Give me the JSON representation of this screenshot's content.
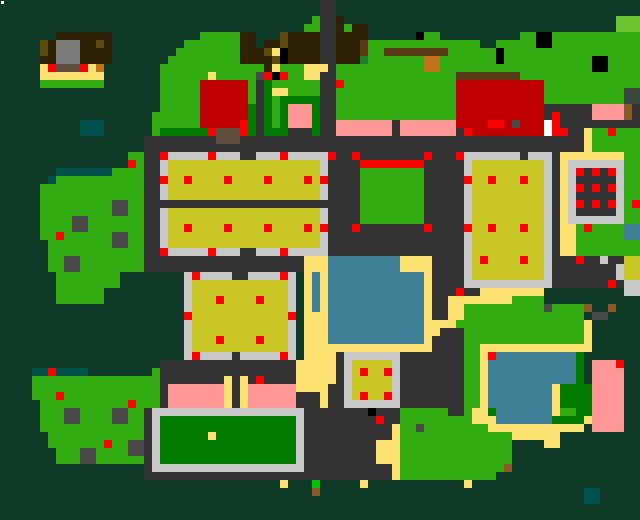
{
  "map": {
    "width_px": 640,
    "height_px": 520,
    "tile_size": 8,
    "cols": 80,
    "rows": 65,
    "palette": {
      ".": "#0d3926",
      "g": "#33ac12",
      "G": "#007b00",
      "l": "#6cc42e",
      "f": "#1e7d2b",
      "y": "#c9c626",
      "s": "#fce170",
      "r": "#323232",
      "L": "#c8c8c8",
      "m": "#4a4a4a",
      "M": "#7a7a7a",
      "R": "#ff0000",
      "D": "#c00000",
      "p": "#ff9797",
      "w": "#3e7f95",
      "b": "#2e2105",
      "B": "#5a3a17",
      "o": "#c1731f",
      "n": "#8b5a2b",
      "O": "#5e4b0e",
      "t": "#00514a",
      "W": "#ffffff",
      "K": "#000000",
      "h": "#5e4c3c",
      "e": "#37473c",
      "v": "#00c400"
    },
    "legend": {
      ".": "deep-forest",
      "g": "grass",
      "G": "dark-lawn",
      "l": "light-grass",
      "f": "shrub",
      "y": "crop-field",
      "s": "sand-path",
      "r": "road",
      "L": "pavement-border",
      "m": "rock",
      "M": "gray-roof",
      "R": "red-marker",
      "D": "red-building",
      "p": "pink-building",
      "w": "water",
      "b": "dark-brown-building",
      "B": "wood-beam",
      "o": "orange-crate",
      "n": "dirt-patch",
      "O": "olive-roof",
      "t": "dark-pool",
      "W": "white-tile",
      "K": "black-tile",
      "h": "hut-roof",
      "e": "dark-sage",
      "v": "bright-green-marker"
    },
    "rows_rle": [
      ".40 r2 .38",
      ".40 r2 .38",
      ".39 g1 r2 b1 .34 l3",
      ".38 g2 r2 b1 g1 b2 .31 l3",
      ".7 b7 .11 g5 b2 .3 O1 b4 r2 b4 .6 K1 g2 .10 g2 K2 g11",
      ".5 O1 b1 M3 b2 O1 b1 .9 g7 b2 .1 b2 O1 b4 r2 b3 B1 g14 .2 g5 K2 g11",
      ".5 O1 b1 M3 b4 .8 g8 b3 O1 s1 K1 b4 r2 b3 B1 g2 B8 g6 K1 g17",
      ".5 b2 M3 b4 .7 g9 b4 O1 K1 b4 r2 b3 f1 g7 o2 g7 K1 g11 K2 g4",
      ".5 s1 R1 h3 R1 s1 o1 .7 g13 b1 s1 g3 s3 r1 g11 o2 g19 K2 g4",
      ".5 s8 .7 g6 s1 g5 m1 R1 K1 R1 g2 s2 r2 g15 B8 g15",
      ".5 g8 .7 g5 D6 g1 r1 G1 g6 r2 R1 g14 D11 g12",
      ".20 g5 D6 g1 r1 G1 s2 g4 r2 g15 D11 g10 e2",
      ".20 g5 D6 g1 r1 G1 g1 G5 r2 g15 D11 g10 e2",
      ".20 g5 D6 G1 r1 G1 g1 G1 p3 G1 r2 g15 D11 r6 p4 n1 r1",
      ".19 g6 D6 G1 r1 G1 g1 G1 p3 G1 r2 g15 D11 r1 R1 r4 p4 n1 r1",
      ".10 t3 .6 g6 D5 R1 G1 r1 G1 g1 G1 p3 G1 r2 p7 r1 p7 D4 R2 D1 m1 D3 W1 R1 r10",
      ".10 t3 .6 g1 G6 R1 h3 R1 G1 r1 G3 r3 G1 r2 p7 r1 p7 r1 R1 D9 W1 R2 r2 s1 g2 R1 g3",
      ".18 r9 h3 r43 s1 g6",
      ".18 r55 s1 g6",
      ".16 g2 r2 R1 L5 R1 L3 r2 L3 R1 L5 R1 r2 R1 r8 R1 r3 R1 L7 r1 L3 r1 s8 g2",
      ".16 R1 g1 r2 L1 y19 L1 r4 R8 r5 L1 y9 L1 r1 s1 L7 g2",
      ".7 t7 g4 r2 L1 y19 L1 r4 g8 r5 L1 y9 L1 r1 s1 L1 R1 r1 R1 r1 R1 L1 g2",
      ".6 t1 g11 r2 R1 y2 R1 y4 R1 y4 R1 y4 R1 y1 R1 r4 g8 r5 R1 y2 R1 y3 R1 y2 L1 r1 s1 L1 r5 L1 g2",
      ".5 g13 r2 L1 y19 L1 r4 g8 r5 L1 y9 L1 r1 s1 L1 R1 r1 R1 r1 R1 L1 g2",
      ".5 g13 r2 L1 y19 L1 r4 g8 r5 L1 y9 L1 r1 s1 L1 r5 L1 g2",
      ".5 g9 m2 g2 r27 g8 r5 L1 y9 L1 r1 s1 L1 R1 r1 R1 r1 R1 L1 g1 R1",
      ".5 g9 m2 g2 r2 L1 y19 L1 r4 g8 r5 L1 y9 L1 r1 s1 L1 r5 L1 g2",
      ".5 g4 m2 g7 r2 L1 y19 L1 r4 g8 r5 L1 y9 L1 r1 s1 L7 g2",
      ".5 g4 m2 g7 r2 L1 y2 R1 y4 R1 y4 R1 y4 R1 y1 R1 r3 R1 r8 R1 r4 R1 y2 R1 y3 R1 y2 L1 r1 s2 g1 R1 g4 w2",
      ".5 g2 R1 g6 m2 g2 r2 L1 y19 L1 r17 L1 y9 L1 r1 s2 g6 w2",
      ".6 g8 m2 g2 r2 L1 y19 L1 r17 L1 y9 L1 r1 s2 g8",
      ".6 g12 r2 R1 L5 R1 L3 r2 L3 R1 L5 r17 L1 y9 L1 r1 s2 g8",
      ".6 g2 m2 g8 r20 s3 w9 s4 r4 L1 y1 R1 y4 R1 y2 L1 r3 R1 r2 L1 r2 y2",
      ".6 g2 m2 g8 r20 s3 w9 s4 r4 L1 y9 L1 r8 L1 y2",
      ".7 g8 .8 L1 R1 L4 r2 L4 R1 L1 .1 s1 w1 s1 w12 s1 r4 L1 y9 L1 r8 L1 y2",
      ".7 g8 .8 L1 y12 L1 .1 s1 w1 s1 w12 s1 r4 L11 r7 R1 r1 L2",
      ".7 g6 .10 L1 y12 L1 .1 s1 w1 s1 w12 s1 r3 R1 r2 s8 .10 L2",
      ".7 g6 .10 L1 y3 R1 y4 R1 y3 L1 .1 s1 w1 s1 w12 s1 r2 s8 g4 .12",
      ".23 L1 y12 L1 .1 s1 w1 s1 w12 s1 r2 s2 g10 m1 g4 n1 .2 n1 .3",
      ".23 R1 y12 R1 .1 s3 w12 s1 r2 s2 g15 .1 m2 .4",
      ".23 L1 y12 L1 .1 s3 w12 s4 g16 s1 .6",
      ".23 L1 y12 L1 .1 s3 w12 s2 r3 g15 s1 .6",
      ".23 L1 y3 R1 y4 R1 y3 L1 .1 s3 w12 s1 r4 g15 s1 .6",
      ".23 L1 y12 L1 .1 s16 r4 g2 s14 .6",
      ".23 L1 R1 L4 r1 L5 R1 L1 .1 s4 r1 L7 r8 g2 s1 R1 w10 G1 .7",
      ".20 r17 s5 r1 L1 y5 L1 r8 g2 s1 w11 G1 .1 p3 R1 .2",
      ".4 t2 R1 t4 .8 g1 r17 s5 r1 L1 y1 R1 y2 R1 L1 r8 g2 s1 w11 G1 .1 p4 .2",
      ".4 g16 r8 s1 r1 s1 r1 R1 r4 s5 r1 L1 y5 L1 r8 g2 s1 w11 G1 .1 p4 .2",
      ".4 g16 r1 p7 s1 r1 s1 p6 s4 r2 L1 y5 L1 r8 g2 s1 w8 s1 G4 p4 .2",
      ".4 g3 R1 g12 r1 p7 s1 r1 s1 p6 r3 s1 r2 L1 y1 R1 y2 R1 L1 r8 g2 s1 w8 s1 G4 p4 .2",
      ".5 g11 R1 g3 r1 p7 s1 r1 s1 p6 r3 s1 r2 L7 r8 g2 s1 w8 s1 G4 p4 .2",
      ".5 g3 m2 g4 m2 g2 r1 L19 r8 K1 r3 g6 r2 g1 s2 G1 w7 s1 g2 G2 p4 .2",
      ".5 g3 m2 g4 m2 g2 r1 L1 G17 L1 r9 R1 r2 g9 s3 w7 G4 s1 p4 .2",
      ".5 g13 r1 L1 G17 L1 r11 s1 g2 m1 g8 s12 .1 p4 .2",
      ".6 g12 r1 L1 G6 s1 G10 L1 r11 s1 g14 s6 .10",
      ".6 g7 R1 g2 m2 r1 L1 G17 L1 r9 s3 g14 .4 s2 .10",
      ".7 g3 m2 g4 m2 r1 L1 G17 L1 r9 s3 g14 .16",
      ".7 g3 m2 g6 r1 L1 G17 L1 r9 s3 g14 .16",
      ".18 r1 L19 r11 s1 g13 n1 .16",
      ".18 r31 s1 g12 .18",
      ".35 s1 .3 v1 .5 s1 .12 s1 .21",
      ".39 n1 .33 t2 .5",
      ".73 t2 .5",
      ".80",
      ".80"
    ],
    "extras": [
      {
        "name": "white-dot",
        "x": 1,
        "y": 1,
        "w": 3,
        "h": 3,
        "color": "#ffffff"
      }
    ]
  }
}
